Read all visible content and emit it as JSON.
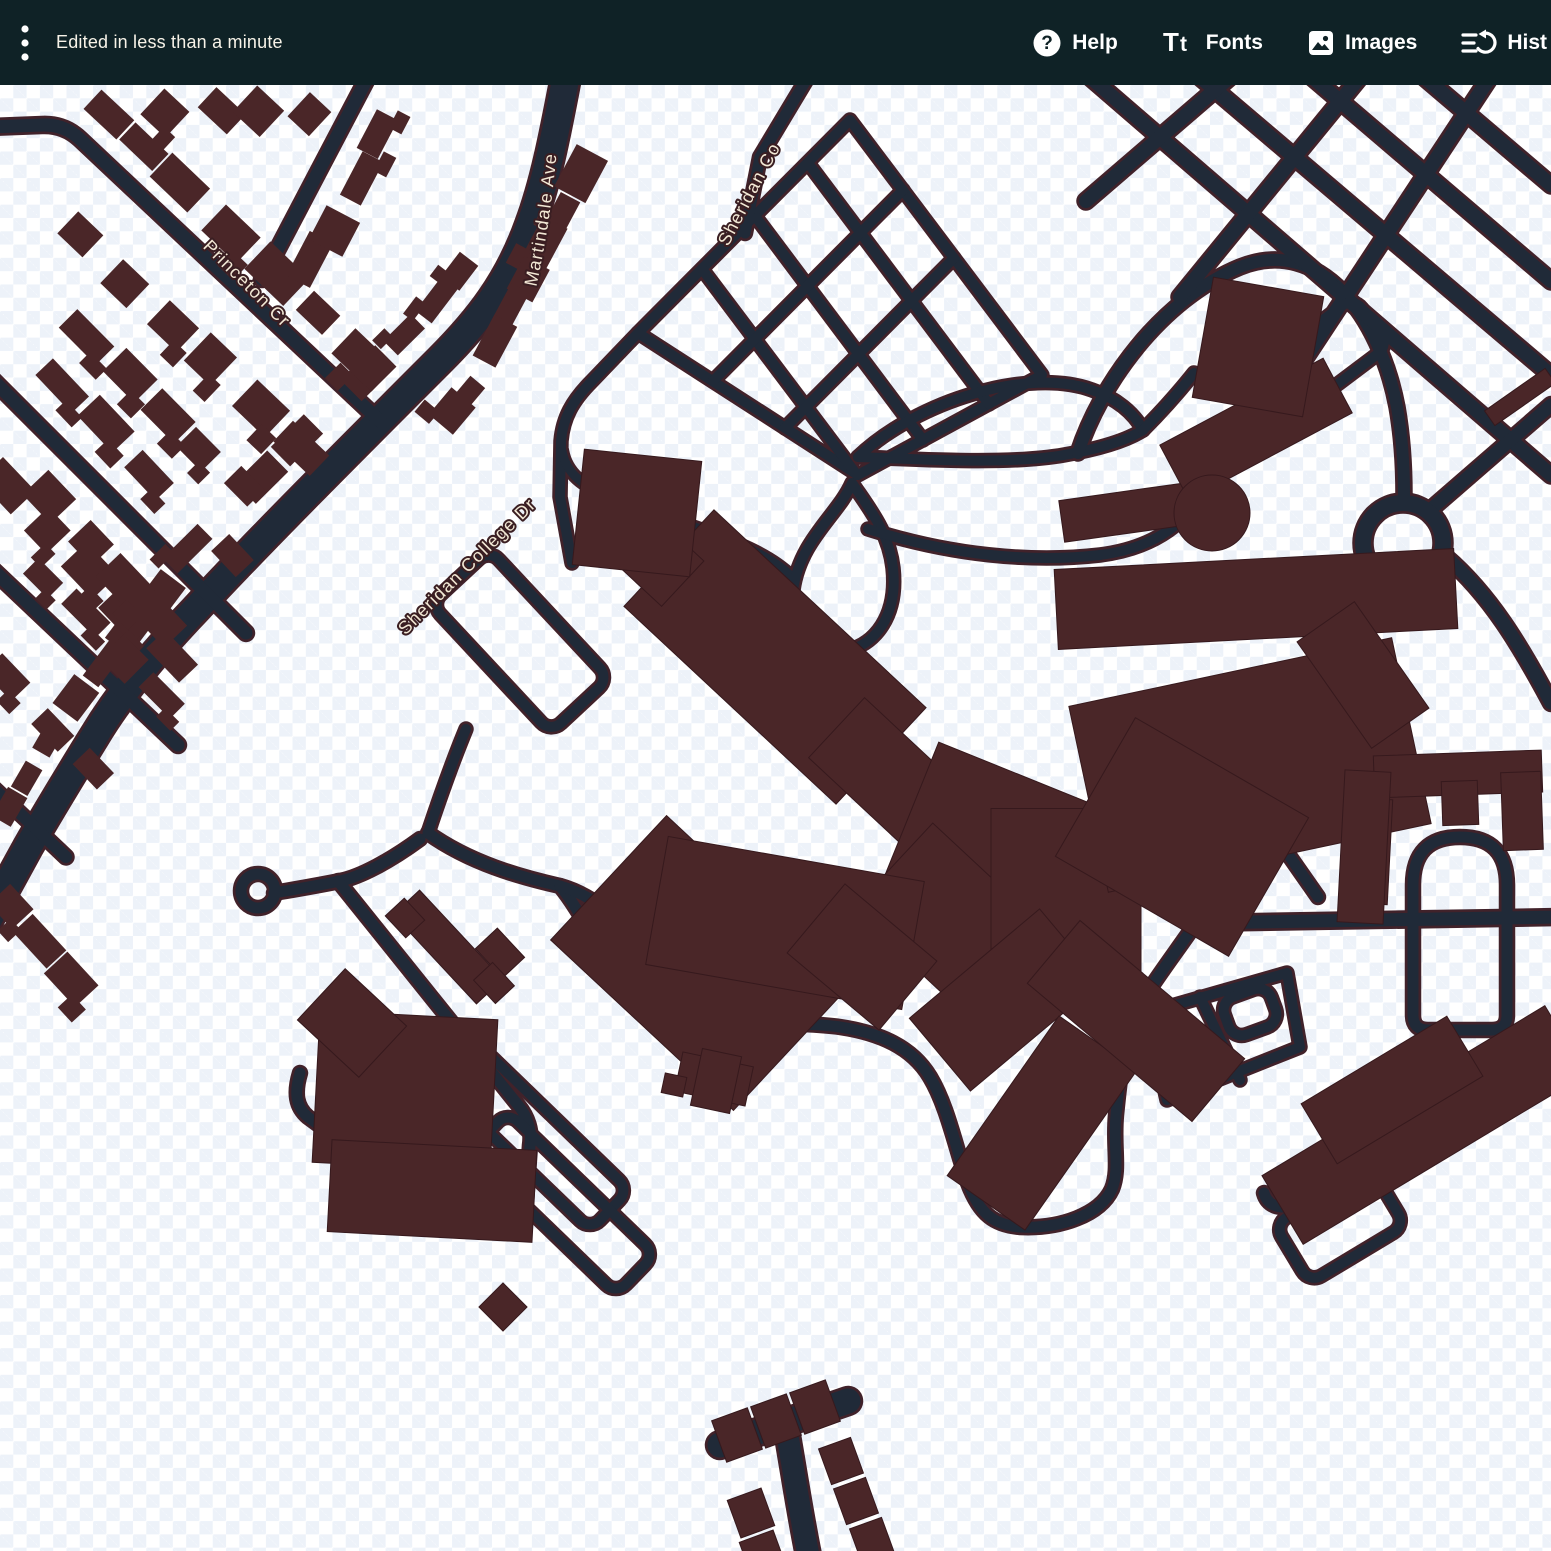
{
  "toolbar": {
    "status_text": "Edited in less than a minute",
    "actions": [
      {
        "label": "Help",
        "icon": "help-circle-icon"
      },
      {
        "label": "Fonts",
        "icon": "text-fonts-icon"
      },
      {
        "label": "Images",
        "icon": "image-icon"
      },
      {
        "label": "Hist",
        "icon": "history-icon"
      }
    ]
  },
  "map": {
    "street_labels": {
      "princeton": "Princeton Cr",
      "martindale": "Martindale Ave",
      "sheridan_college": "Sheridan College Dr",
      "sheridan_top": "Sheridan Co"
    },
    "colors": {
      "toolbar_bg": "#0f2226",
      "road": "#202a38",
      "road_casing": "#41222a",
      "building": "#4a2628",
      "building_stroke": "#36191d",
      "checker": "#edf2f9",
      "label_text": "#f2e8d5",
      "label_halo": "#3a1e22"
    }
  }
}
